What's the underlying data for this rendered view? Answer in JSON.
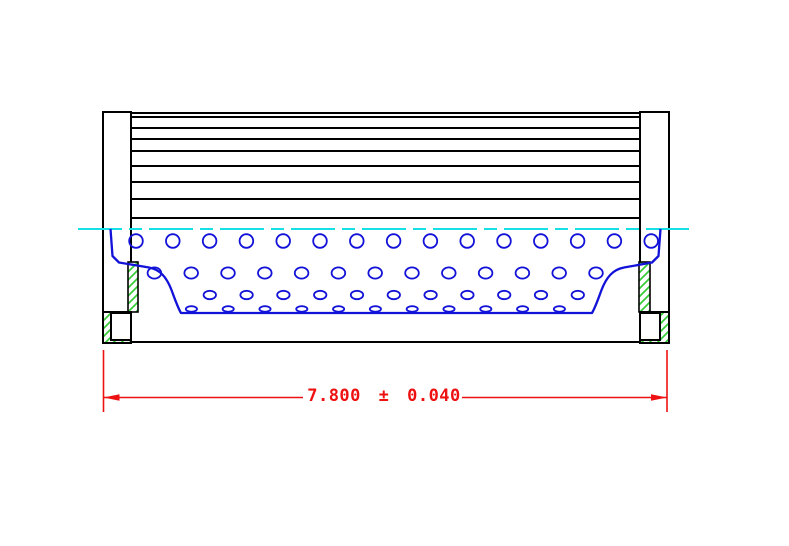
{
  "drawing": {
    "title": "filter-element-cross-section",
    "dimension": {
      "label": "7.800 ± 0.040",
      "value": "7.800",
      "tolerance": "0.040"
    },
    "colors": {
      "outline": "#000000",
      "perforation_blue": "#1212d8",
      "centerline_cyan": "#16dfe6",
      "hatch_green": "#35cc35",
      "dimension_red": "#ee1111",
      "background": "#ffffff"
    },
    "geometry": {
      "canvas": {
        "w": 789,
        "h": 546
      },
      "pleats": {
        "x1": 131,
        "x2": 640,
        "ys": [
          113,
          117,
          128,
          139,
          151,
          166,
          182,
          199,
          218
        ],
        "stroke_w": 2
      },
      "caps": [
        {
          "x": 103,
          "y": 112,
          "w": 28,
          "h": 200
        },
        {
          "x": 640,
          "y": 112,
          "w": 29,
          "h": 200
        }
      ],
      "hatch_strips": [
        {
          "x": 128,
          "y": 262,
          "w": 10,
          "h": 50
        },
        {
          "x": 639,
          "y": 262,
          "w": 11,
          "h": 50
        }
      ],
      "feet_outer": [
        {
          "x": 103,
          "y": 312,
          "w": 28,
          "h": 31
        },
        {
          "x": 640,
          "y": 312,
          "w": 29,
          "h": 31
        }
      ],
      "feet_inner": [
        {
          "x": 111,
          "y": 313,
          "w": 20,
          "h": 27
        },
        {
          "x": 640,
          "y": 313,
          "w": 20,
          "h": 27
        }
      ],
      "bottom_line": {
        "y": 342,
        "x1": 131,
        "x2": 640
      },
      "centerline": {
        "y": 229,
        "x1": 78,
        "x2": 689,
        "dash": "44 7 13 7"
      },
      "perforation_rows": [
        {
          "y": 241,
          "rx": 6.8,
          "ry": 6.8,
          "x0": 136.0,
          "step": 36.8,
          "count": 15
        },
        {
          "y": 273,
          "rx": 6.8,
          "ry": 5.6,
          "x0": 154.4,
          "step": 36.8,
          "count": 13
        },
        {
          "y": 295,
          "rx": 6.2,
          "ry": 4.2,
          "x0": 209.8,
          "step": 36.8,
          "count": 11
        },
        {
          "y": 309,
          "rx": 5.6,
          "ry": 2.8,
          "x0": 191.4,
          "step": 36.8,
          "count": 11
        }
      ],
      "core_profile_path": "M 110.5,229 L 112.5,256 L 119,262.5 L 149,267.5 C 160,269.5 166.5,277 171.5,290 C 174.5,298 177.5,307 181,313 L 592,313 C 595.5,307 598.5,298 601.5,290 C 606.5,277 613,269.5 624,267.5 L 652,262.5 L 658.5,256 L 660.5,229",
      "dim": {
        "ext_x_left": 103.5,
        "ext_x_right": 667,
        "ext_y1": 350,
        "ext_y2": 412,
        "line_y": 397.5,
        "gap_x1": 303,
        "gap_x2": 462,
        "text_cx": 384,
        "text_cy": 397,
        "arrow_len": 16,
        "arrow_half_w": 3.2
      }
    }
  }
}
